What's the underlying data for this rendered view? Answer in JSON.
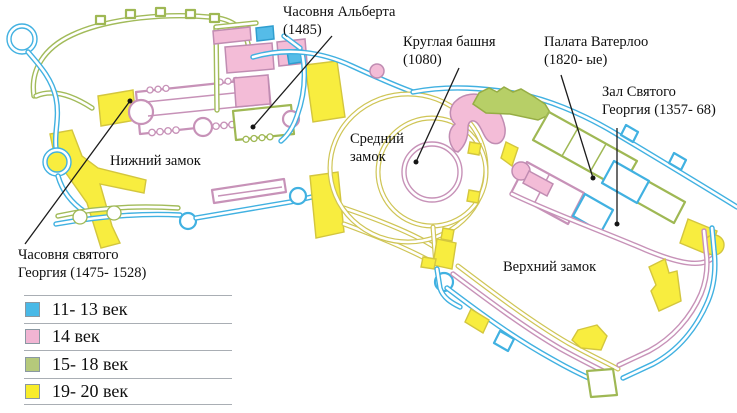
{
  "annotations": {
    "albert_chapel": {
      "line1": "Часовня Альберта",
      "line2": "(1485)"
    },
    "round_tower": {
      "line1": "Круглая башня",
      "line2": "(1080)"
    },
    "waterloo_chamber": {
      "line1": "Палата Ватерлоо",
      "line2": "(1820- ые)"
    },
    "st_george_hall": {
      "line1": "Зал Святого",
      "line2": "Георгия (1357- 68)"
    },
    "lower_ward": {
      "line1": "Нижний замок"
    },
    "middle_ward": {
      "line1": "Средний",
      "line2": "замок"
    },
    "upper_ward": {
      "line1": "Верхний замок"
    },
    "st_george_chapel": {
      "line1": "Часовня святого",
      "line2": "Георгия (1475- 1528)"
    }
  },
  "legend": {
    "rows": [
      {
        "label": "11- 13 век",
        "color": "#49b9e7"
      },
      {
        "label": "14 век",
        "color": "#f1b5d3"
      },
      {
        "label": "15- 18 век",
        "color": "#b5c97b"
      },
      {
        "label": "19- 20 век",
        "color": "#f8ed2a"
      }
    ]
  },
  "map_colors": {
    "walls_11_13c_blue": "#41b1e1",
    "walls_14c_pink": "#c792b8",
    "walls_15_18c_green": "#a2bb5a",
    "walls_19_20c_yellow": "#f8ed3f",
    "moat_olive": "#cfc556"
  }
}
